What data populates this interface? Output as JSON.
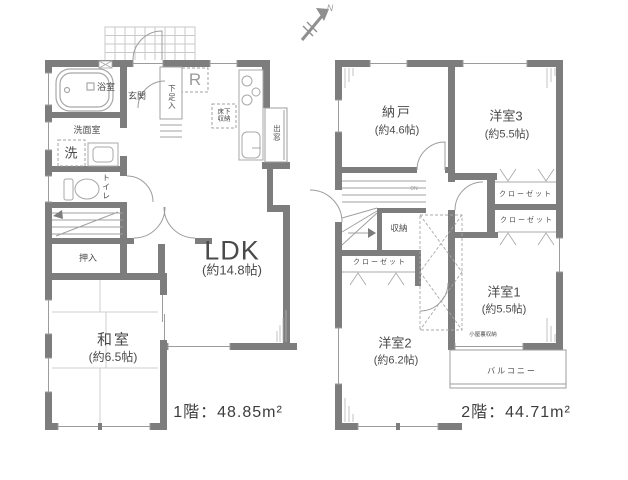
{
  "colors": {
    "wall": "#7d7d7d",
    "line_thin": "#9c9c9c",
    "line_light": "#b5b5b5",
    "text": "#4a4a4a",
    "background": "#ffffff"
  },
  "compass": {
    "north_label": "N"
  },
  "floor1": {
    "area_label": "1階：48.85m²",
    "bath": "浴室",
    "washroom": "洗面室",
    "washer": "洗",
    "toilet": "トイレ",
    "entrance": "玄関",
    "shoe_cabinet": "下足入",
    "refrigerator": "R",
    "floor_storage": "床下\n収納",
    "bay_window": "出窓",
    "oshiire": "押入",
    "ldk": {
      "name": "LDK",
      "size": "(約14.8帖)"
    },
    "washitsu": {
      "name": "和室",
      "size": "(約6.5帖)"
    }
  },
  "floor2": {
    "area_label": "2階：44.71m²",
    "nando": {
      "name": "納戸",
      "size": "(約4.6帖)"
    },
    "yoshitsu3": {
      "name": "洋室3",
      "size": "(約5.5帖)"
    },
    "yoshitsu1": {
      "name": "洋室1",
      "size": "(約5.5帖)"
    },
    "yoshitsu2": {
      "name": "洋室2",
      "size": "(約6.2帖)"
    },
    "closet_y3": "クローゼット",
    "closet_y1": "クローゼット",
    "closet_y2": "クローゼット",
    "storage": "収納",
    "stairs_down": "DN",
    "attic_storage": "小屋裏収納",
    "balcony": "バルコニー"
  }
}
